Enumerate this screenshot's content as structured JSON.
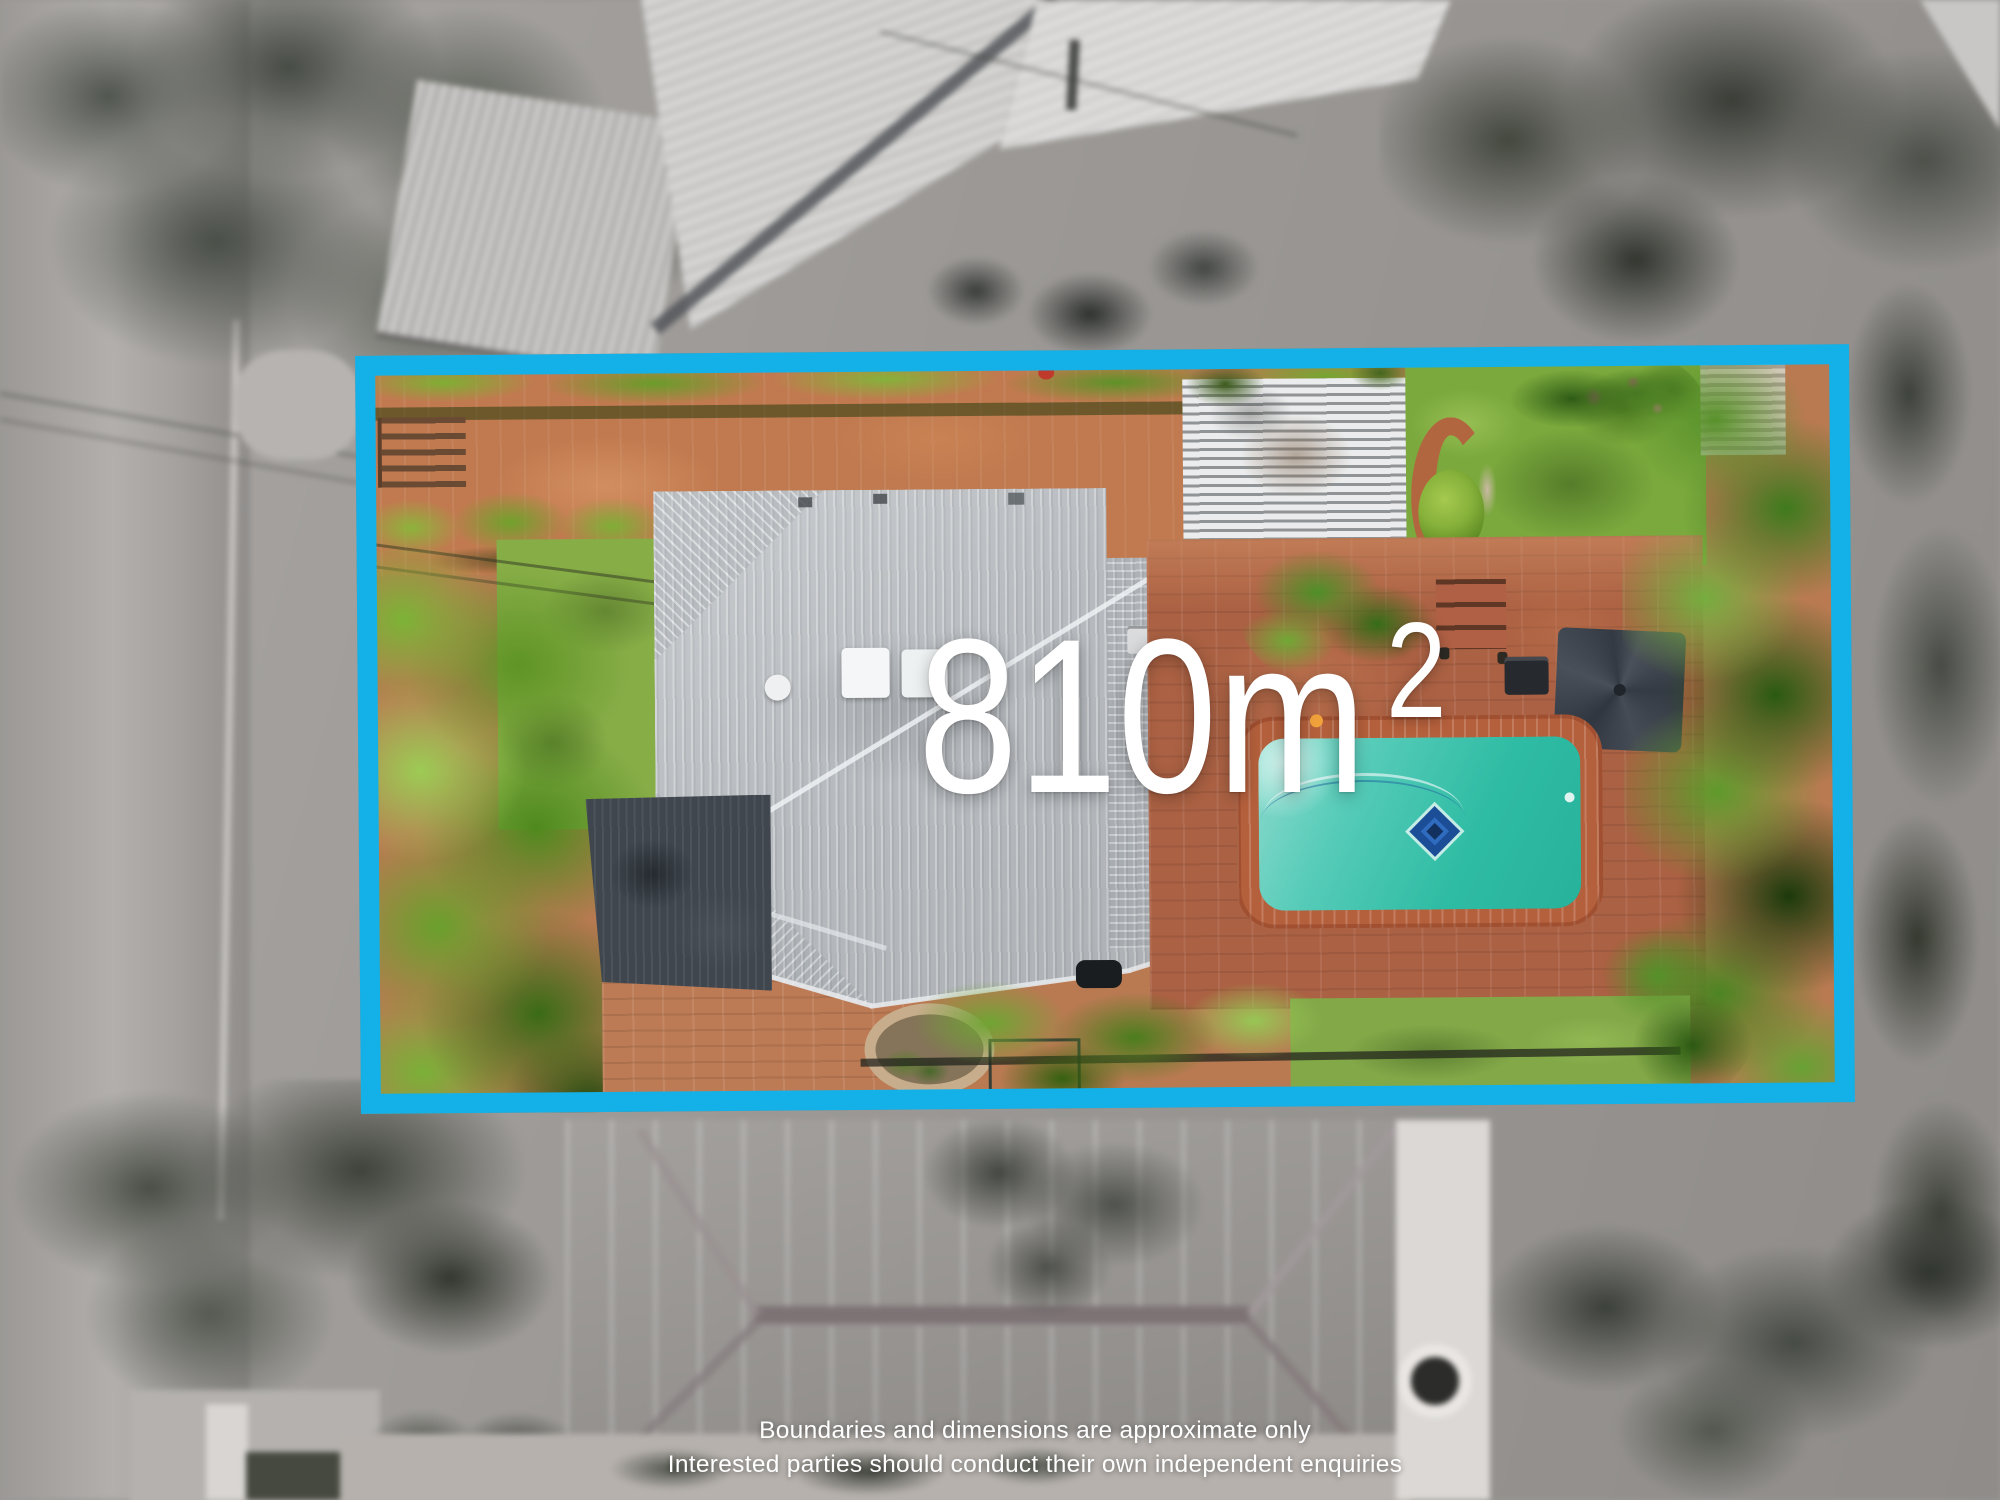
{
  "image_type": "real-estate aerial property photo with land-size overlay",
  "land_size_overlay": {
    "value": "810",
    "unit": "m",
    "exponent": "2",
    "display": "810m2"
  },
  "boundary": {
    "shape": "rectangle outline around property",
    "color": "#14b1e9"
  },
  "disclaimer": {
    "line1": "Boundaries and dimensions are approximate only",
    "line2": "Interested parties should conduct their own independent enquiries"
  },
  "palette": {
    "boundary_blue": "#14b1e9",
    "overlay_text_white": "#ffffff",
    "house_roof_gray": "#b7bbbf",
    "garage_roof_dark": "#3f464e",
    "brick_terracotta": "#b5603c",
    "courtyard_terracotta": "#c17a4f",
    "pool_turquoise": "#2fbca4",
    "pool_mosaic_blue": "#1c4d97",
    "foliage_green": "#5f9426",
    "lawn_green": "#87ad47",
    "pergola_gray": "#c6c9cb",
    "umbrella_charcoal": "#3a4049",
    "outside_grayscale": "#9a9795",
    "neighbor_roof_taupe": "#8f8486"
  },
  "scene_features": [
    "street",
    "neighbor-houses",
    "tree-canopy",
    "hedges",
    "terracotta-courtyard",
    "garden-stairs",
    "lawn",
    "house-metal-roof",
    "skylights",
    "roof-vents",
    "garage-roof",
    "pergola",
    "garden-path",
    "garden-steps",
    "brick-patio",
    "patio-umbrella",
    "bbq",
    "swimming-pool",
    "pool-mosaic",
    "palm-trees",
    "garden-bed",
    "neighbor-roof-below",
    "footpath",
    "satellite-dish"
  ]
}
